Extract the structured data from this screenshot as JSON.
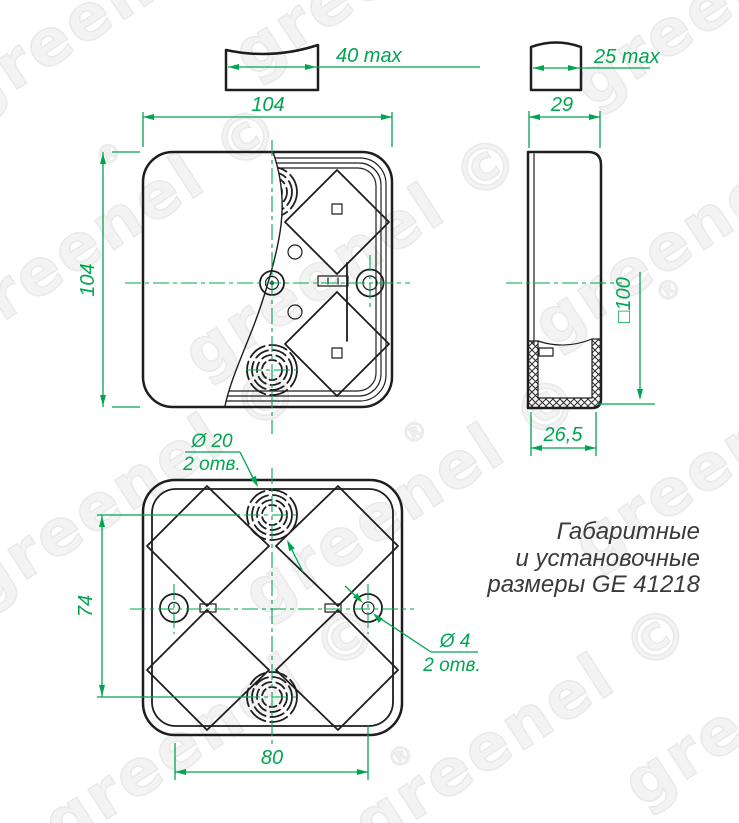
{
  "watermark": {
    "text": "greenel ©",
    "reg": "®"
  },
  "title": {
    "line1": "Габаритные",
    "line2": "и установочные",
    "line3": "размеры GE 41218"
  },
  "views": {
    "front": {
      "width_dim": "104",
      "height_dim": "104",
      "knockout_profile_dim": "40 max"
    },
    "side": {
      "width_dim": "29",
      "inner_depth_dim": "□100",
      "inner_bottom_width_dim": "26,5",
      "knockout_profile_dim": "25 max"
    },
    "bottom": {
      "knockout_spacing_dim": "74",
      "mount_hole_spacing_dim": "80",
      "knockout_callout": {
        "dia": "Ø 20",
        "qty": "2 отв."
      },
      "mount_hole_callout": {
        "dia": "Ø 4",
        "qty": "2 отв."
      }
    }
  },
  "colors": {
    "dimension_green": "#00A54F",
    "line_black": "#1E1E1E",
    "title_text": "#3A3A3A",
    "watermark": "#ECECEC"
  }
}
